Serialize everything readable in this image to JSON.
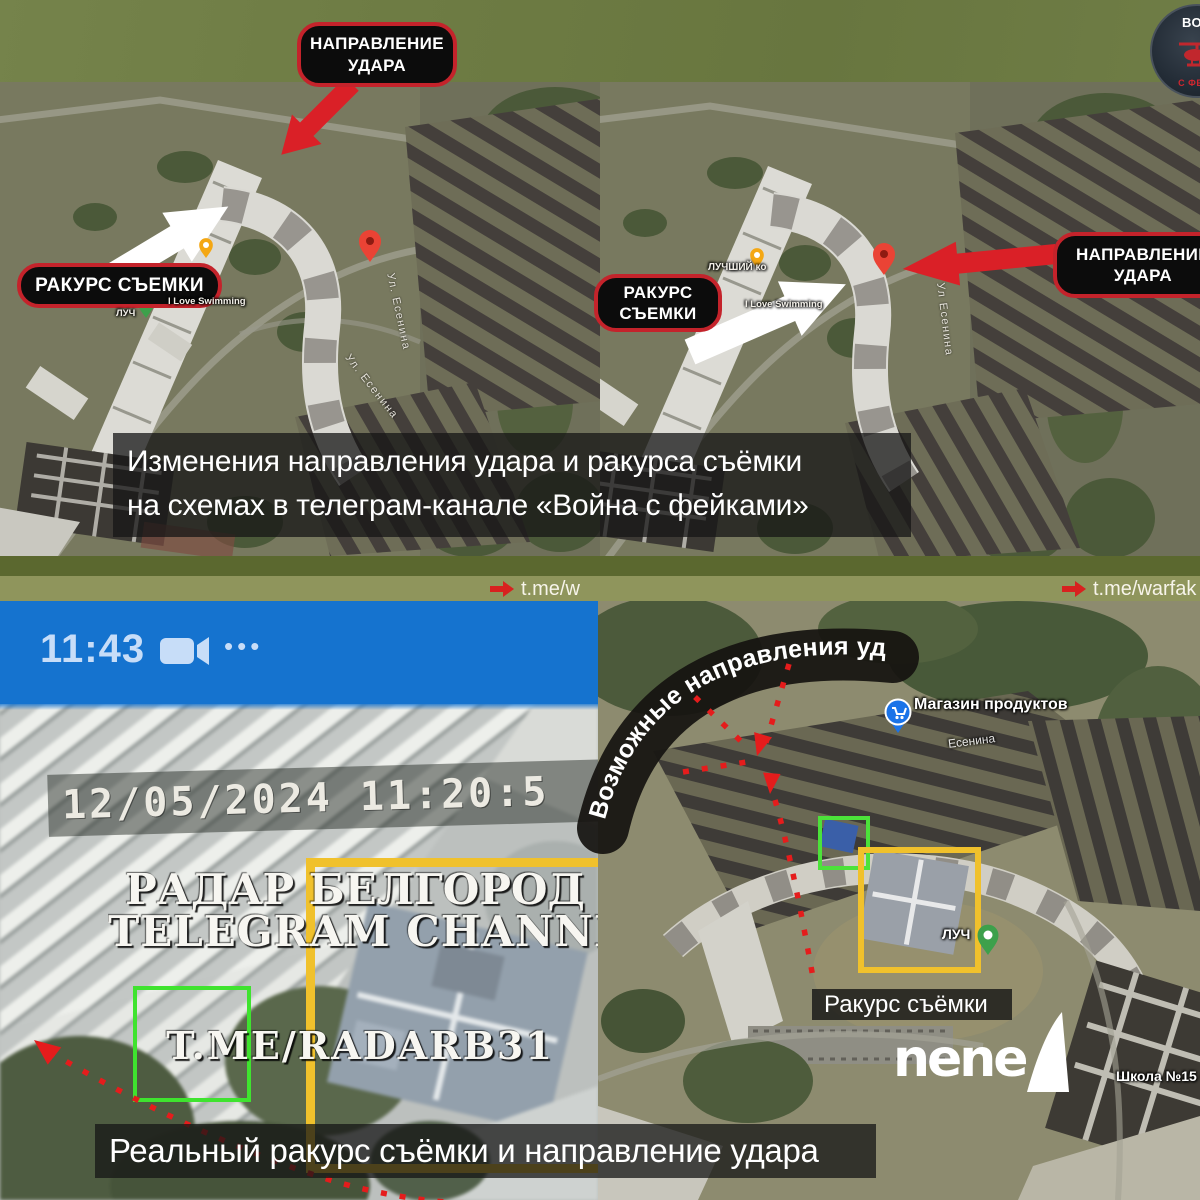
{
  "logo": {
    "line_top": "ВОЙ",
    "line_bottom": "С ФЕЙК"
  },
  "maps_top": {
    "left": {
      "strike_label_line1": "НАПРАВЛЕНИЕ",
      "strike_label_line2": "УДАРА",
      "angle_label": "РАКУРС СЪЕМКИ",
      "street_label_a": "Ул. Есенина",
      "street_label_b": "Ул. Есенина",
      "poi_swimming": "I Love Swimming",
      "poi_luchik": "ЛУЧ"
    },
    "right": {
      "angle_label_line1": "РАКУРС",
      "angle_label_line2": "СЪЕМКИ",
      "strike_label_line1": "НАПРАВЛЕНИЕ",
      "strike_label_line2": "УДАРА",
      "street_label": "Ул Есенина",
      "poi_best": "ЛУЧШИЙ ко",
      "poi_swimming": "I Love Swimming"
    }
  },
  "caption_top": {
    "line1": "Изменения направления удара и ракурса съёмки",
    "line2": "на схемах в телеграм-канале «Война с фейками»"
  },
  "links_strip": {
    "left_link": "t.me/w",
    "right_link": "t.me/warfak"
  },
  "video_panel": {
    "status_time": "11:43",
    "menu_dots": "•••",
    "cctv_timestamp": "12/05/2024 11:20:5",
    "watermark_title": "РАДАР БЕЛГОРОД",
    "watermark_subtitle": "TELEGRAM CHANNEL",
    "watermark_handle": "T.ME/RADARB31"
  },
  "map_bottom_right": {
    "curved_banner": "Возможные направления удара",
    "poi_shop": "Магазин продуктов",
    "street_label": "Есенина",
    "poi_luch": "ЛУЧ",
    "poi_school": "Школа №15 «Л",
    "angle_caption": "Ракурс съёмки",
    "nene_wordmark": "nene"
  },
  "caption_bottom": {
    "text": "Реальный ракурс съёмки и направление удара"
  },
  "colors": {
    "olive_banner": "#6f7d45",
    "strip_dark": "#5b682f",
    "strip_light": "#8f955c",
    "annotation_red": "#da2027",
    "label_border_red": "#c4232b",
    "box_yellow": "#f0c12c",
    "box_green": "#3fe32f",
    "status_bar_blue": "#1573cf"
  }
}
